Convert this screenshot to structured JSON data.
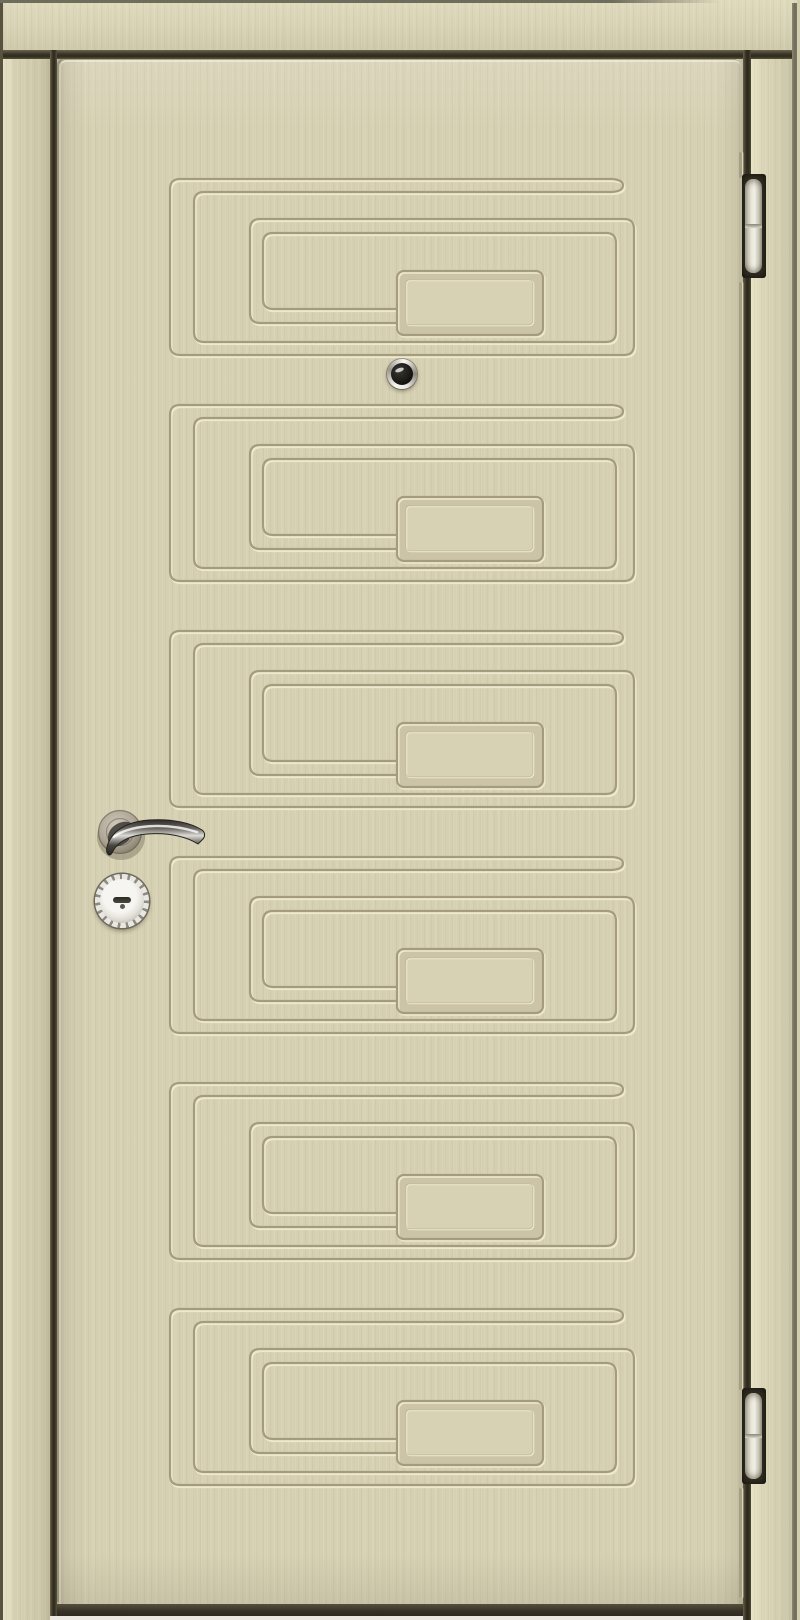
{
  "scene": {
    "label": "Front view photograph of a closed cream-beige security entry door in its frame",
    "width": 800,
    "height": 1620
  },
  "door": {
    "label": "door leaf with six embossed Greek-key spiral panels",
    "panel_count": 6,
    "panel": {
      "left": 106,
      "width": 478,
      "height": 190
    },
    "panel_tops": [
      113,
      339,
      565,
      791,
      1017,
      1243
    ],
    "edge_line_segments": [
      {
        "top": 93,
        "height": 26
      },
      {
        "top": 223,
        "height": 1108
      },
      {
        "top": 1429,
        "height": 110
      }
    ]
  },
  "hardware": {
    "peephole": {
      "label": "round chrome deadbolt keyhole above second panel",
      "left": 330,
      "top": 300,
      "size": 30
    },
    "handle": {
      "label": "curved lever handle on round brushed-nickel rosette",
      "left": 24,
      "top": 738,
      "width": 140,
      "height": 80
    },
    "cylinder": {
      "label": "round keyed lock cylinder escutcheon below handle",
      "left": 38,
      "top": 815,
      "size": 54
    },
    "hinges": {
      "label": "white barrel hinges mortised in right frame gap",
      "count": 2,
      "left": 742,
      "width": 24,
      "tops": [
        174,
        1388
      ],
      "heights": [
        104,
        96
      ]
    }
  },
  "frame": {
    "label": "cream door frame with dark reveal gaps",
    "lintel_height": 50,
    "left_jamb_width": 50,
    "right_jamb_width": 49
  },
  "floor": {
    "label": "light floor strip under the door"
  },
  "colors": {
    "door_base": "#d6d0b3",
    "frame_base": "#dad4b7",
    "groove_dark": "#a59c7d",
    "groove_highlight": "#eee8cf",
    "panel_bevel_face": "#cbc4a6",
    "reveal_gap": "#3a3527",
    "outer_edge_line": "#57533f",
    "floor_strip": "#ebe9e1",
    "threshold_shadow": "#393428",
    "hinge_barrel": "#e5e2d6",
    "hinge_recess": "#322e22",
    "handle_metal_dark": "#33302c",
    "handle_metal_highlight": "#e3e1dd",
    "rosette_metal": "#b2aa9a",
    "chrome_ring": "#e8e7e3",
    "keyway_dark": "#2c2a23"
  }
}
